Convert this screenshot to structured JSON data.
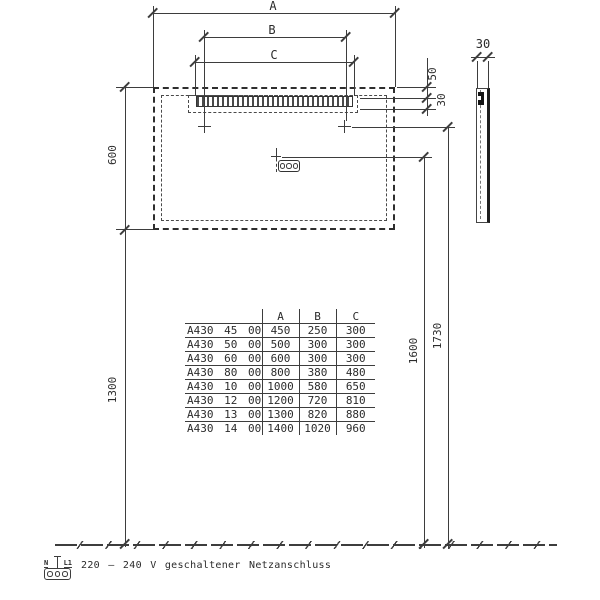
{
  "colors": {
    "line": "#3d3d3d",
    "text": "#2b2b2b",
    "background": "#ffffff"
  },
  "dimensions": {
    "width_total_label": "A",
    "mount_spacing_label": "B",
    "light_width_label": "C",
    "mirror_height": "600",
    "floor_to_mirror_bottom": "1300",
    "connector_height": "1600",
    "mount_height": "1730",
    "light_top_offset": "50",
    "light_fixture_height": "30",
    "mirror_depth": "30"
  },
  "table": {
    "headers": [
      "",
      "A",
      "B",
      "C"
    ],
    "rows": [
      [
        "A430 45 00",
        "450",
        "250",
        "300"
      ],
      [
        "A430 50 00",
        "500",
        "300",
        "300"
      ],
      [
        "A430 60 00",
        "600",
        "300",
        "300"
      ],
      [
        "A430 80 00",
        "800",
        "380",
        "480"
      ],
      [
        "A430 10 00",
        "1000",
        "580",
        "650"
      ],
      [
        "A430 12 00",
        "1200",
        "720",
        "810"
      ],
      [
        "A430 13 00",
        "1300",
        "820",
        "880"
      ],
      [
        "A430 14 00",
        "1400",
        "1020",
        "960"
      ]
    ]
  },
  "power_note": {
    "terminal_n": "N",
    "terminal_l1": "L1",
    "text": "220 – 240 V geschaltener Netzanschluss"
  }
}
